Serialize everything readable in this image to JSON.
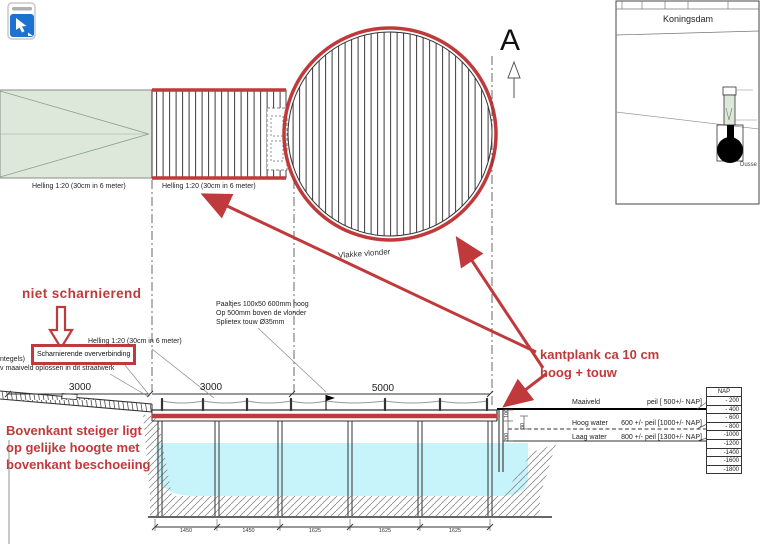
{
  "toolbar": {
    "tool_icon": "cursor-pointer"
  },
  "colors": {
    "annotation_red": "#c03a3c",
    "water_cyan": "#c7f4fa",
    "area_green": "#dde8db",
    "icon_blue": "#1b72d0"
  },
  "plan": {
    "helling_left": "Helling 1:20 (30cm in 6 meter)",
    "helling_right": "Helling 1:20 (30cm in 6 meter)",
    "vlonder_label": "Vlakke vlonder",
    "section_marker": "A"
  },
  "inset": {
    "area_label": "Koningsdam",
    "partial_label": "Dusse"
  },
  "annotations": {
    "niet_scharnierend": "niet scharnierend",
    "scharnierende_box": "Scharnierende oververbinding",
    "bovenkant": [
      "Bovenkant steiger ligt",
      "op gelijke hoogte met",
      "bovenkant beschoeiing"
    ],
    "kantplank": [
      "kantplank ca 10 cm",
      "hoog  + touw"
    ]
  },
  "notes": {
    "paaltjes": [
      "Paaltjes 100x50 600mm hoog",
      "Op 500mm boven de vlonder",
      "Splietex touw Ø35mm"
    ],
    "left_edge": [
      "ntegels)",
      "v maaiveld oplossen in dit straatwerk"
    ],
    "helling_elevation": "Helling 1:20 (30cm in 6 meter)"
  },
  "elevation": {
    "dims_top": [
      "3000",
      "3000",
      "5000"
    ],
    "dims_bottom": [
      "1450",
      "1450",
      "1625",
      "1625",
      "1625"
    ],
    "dims_side": [
      "100",
      "30",
      "200"
    ],
    "levels": [
      {
        "name": "Maaiveld",
        "value": "peil [  500+/- NAP]"
      },
      {
        "name": "Hoog water",
        "value": "600 +/- peil [1000+/- NAP]"
      },
      {
        "name": "Laag water",
        "value": "800 +/- peil [1300+/- NAP]"
      }
    ],
    "nap": {
      "header": "NAP",
      "values": [
        "- 200",
        "- 400",
        "- 600",
        "- 800",
        "-1000",
        "-1200",
        "-1400",
        "-1600",
        "-1800"
      ]
    }
  }
}
